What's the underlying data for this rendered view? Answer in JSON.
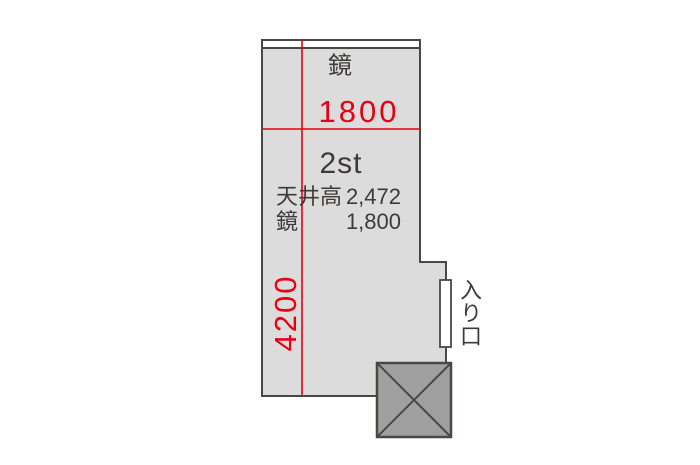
{
  "plan": {
    "room_label": "2st",
    "mirror_label": "鏡",
    "dim_width": "1800",
    "dim_length": "4200",
    "specs": [
      {
        "label": "天井高",
        "value": "2,472"
      },
      {
        "label": "鏡",
        "value": "1,800"
      }
    ],
    "entrance_label": "入り口",
    "colors": {
      "dimension_red": "#e60012",
      "room_fill": "#dcdcdc",
      "outline_dark": "#4a4745",
      "pillar_fill": "#a0a0a0",
      "text_dark": "#3e3a39",
      "background": "#ffffff"
    }
  }
}
